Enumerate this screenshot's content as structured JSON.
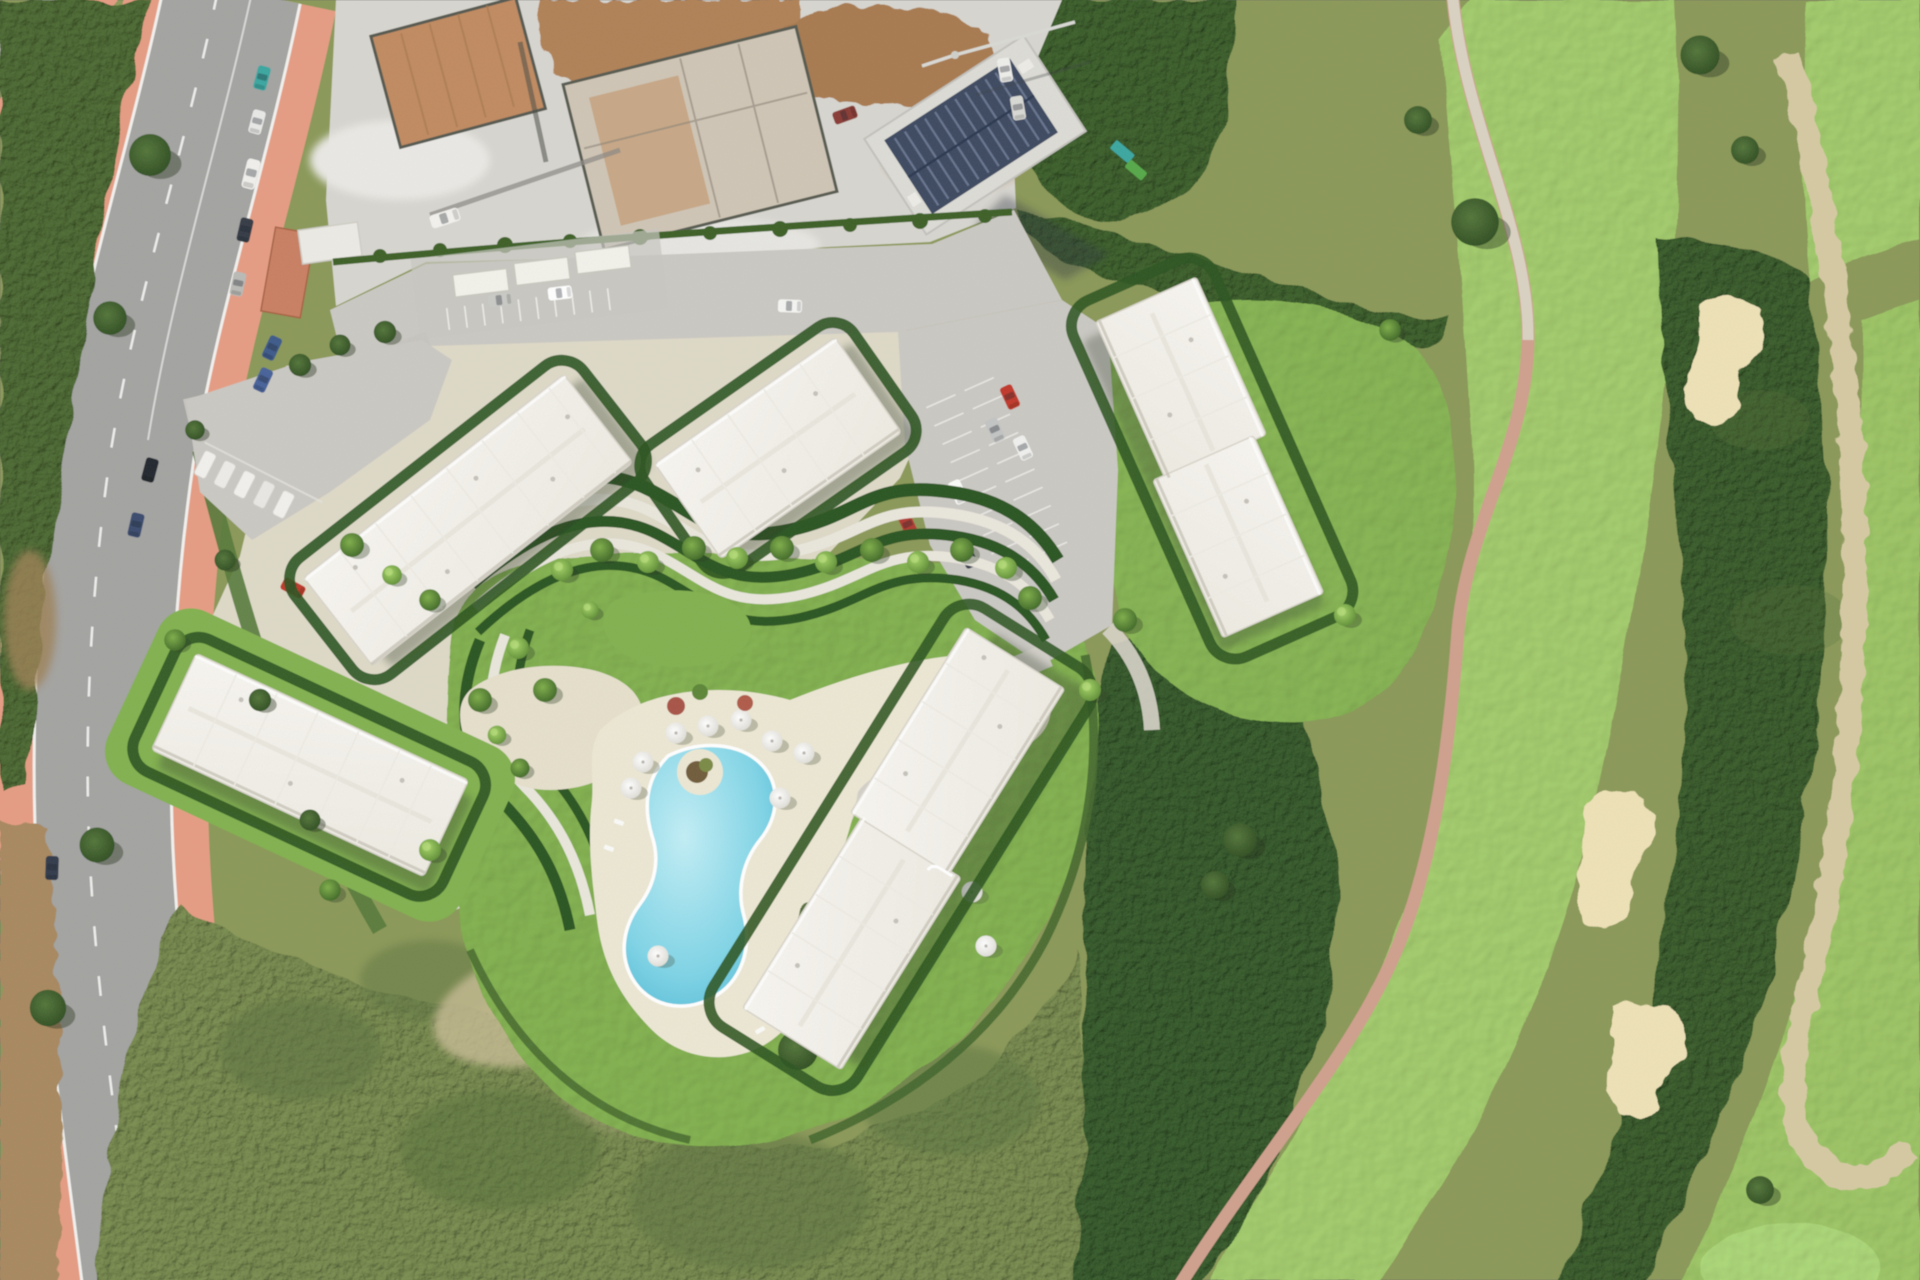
{
  "scene": {
    "type": "aerial-photograph",
    "subject": "residential-development-render-with-road-construction-site-and-golf-course"
  },
  "palette": {
    "ground_olive": "#8a9858",
    "vegetation_dark": "#4c6832",
    "woods": "#3a5d2b",
    "scrub": "#76884e",
    "fairway": "#a2cb6c",
    "fairway_bright": "#abd677",
    "bunker_sand": "#eee1b6",
    "waste_path": "#d5c9a2",
    "cart_path": "#cf9f8d",
    "asphalt": "#a3a3a1",
    "sidewalk_pink": "#e59c83",
    "curb_white": "#f2f1ee",
    "dirt_shoulder": "#a8885e",
    "parcel_pale": "#ded9c7",
    "plaza_gray": "#cac8c2",
    "lawn": "#82b14f",
    "hedge": "#2c5420",
    "path_cream": "#e9e6dc",
    "deck_cream": "#ece7d3",
    "pool_light": "#c2eef6",
    "pool_deep": "#57bdd8",
    "roof_white": "#f7f5f0",
    "roof_shade": "#c9c5ba",
    "shadow": "#2f3a2a",
    "construction_ground": "#d7d5cf",
    "construction_dirt": "#b08157",
    "pad_tan": "#c08a60",
    "solar_roof": "#3e4a61",
    "car_red": "#c0392b",
    "car_teal": "#3aa6a0"
  }
}
